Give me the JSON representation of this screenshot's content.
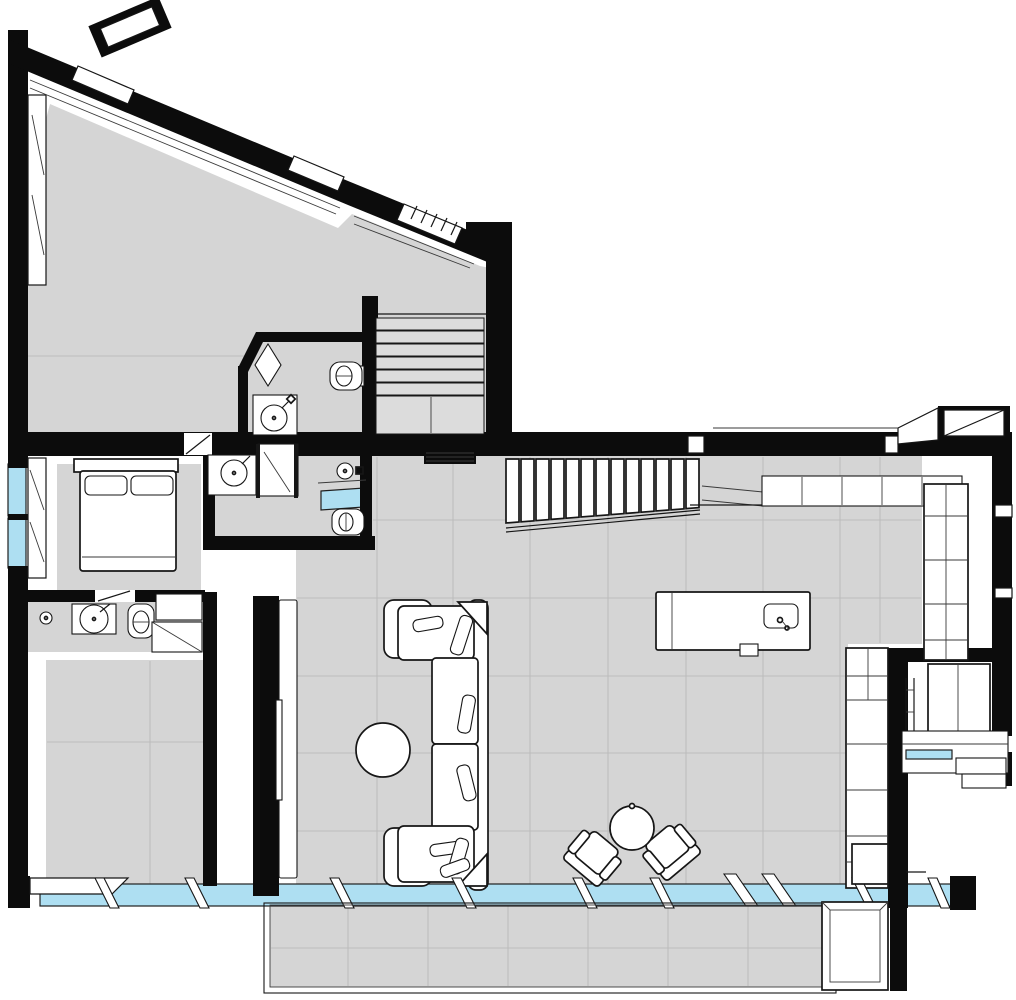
{
  "document": {
    "type": "architectural floor plan drawing",
    "view": "top-down plan with slight axonometric offset",
    "visible_text": "none",
    "style": "black walls, light gray tiled floors, white line furniture, cyan glazing"
  },
  "colors": {
    "background": "#ffffff",
    "wall": "#0c0c0c",
    "outline": "#161616",
    "floor": "#d5d5d5",
    "floor_line": "#bdbdbd",
    "tread": "#dcdcdc",
    "glazing": "#aedff2",
    "white": "#ffffff"
  },
  "rooms": [
    {
      "id": "upper-wing-room-west",
      "label": "angled upper-wing room (west)",
      "features": [
        "diagonal glazed wall",
        "corner window strip"
      ]
    },
    {
      "id": "upper-wing-room-east",
      "label": "angled upper-wing room (east)",
      "features": [
        "stair opening",
        "grille window"
      ]
    },
    {
      "id": "upper-bathroom",
      "label": "upper bathroom",
      "fixtures": [
        "toilet",
        "washbasin",
        "corner door"
      ]
    },
    {
      "id": "bedroom",
      "label": "bedroom",
      "furniture": [
        "double bed",
        "rug"
      ],
      "features": [
        "two cyan side windows"
      ]
    },
    {
      "id": "ensuite-bathroom",
      "label": "en-suite bathroom",
      "fixtures": [
        "washbasin",
        "shower",
        "bathtub",
        "toilet"
      ]
    },
    {
      "id": "lower-bathroom",
      "label": "lower bathroom",
      "fixtures": [
        "floor drain",
        "washbasin",
        "toilet",
        "closet"
      ]
    },
    {
      "id": "lower-left-room",
      "label": "lower-left room"
    },
    {
      "id": "living-room",
      "label": "open living / kitchen area",
      "furniture": [
        "U-shaped sectional sofa",
        "round coffee table",
        "two lounge chairs",
        "round side table",
        "kitchen island with sink",
        "wall counter",
        "tall cabinet",
        "bookcase wall",
        "media wall with TV"
      ]
    },
    {
      "id": "main-staircase",
      "label": "main staircase",
      "treads": 13
    },
    {
      "id": "upper-staircase",
      "label": "upper-wing staircase",
      "treads": 6,
      "landing": true
    },
    {
      "id": "study-nook",
      "label": "study nook (east)",
      "furniture": [
        "desk with glass strip",
        "wardrobe",
        "steps"
      ]
    },
    {
      "id": "terrace",
      "label": "tiled terrace (south)"
    },
    {
      "id": "glazed-facade",
      "label": "south glazed facade with sliding door leaves and mullions"
    }
  ],
  "counts": {
    "toilets": 3,
    "washbasins": 4,
    "staircases": 2,
    "lounge_chairs": 2,
    "chimneys": 2,
    "sofa_pillows": 7
  }
}
